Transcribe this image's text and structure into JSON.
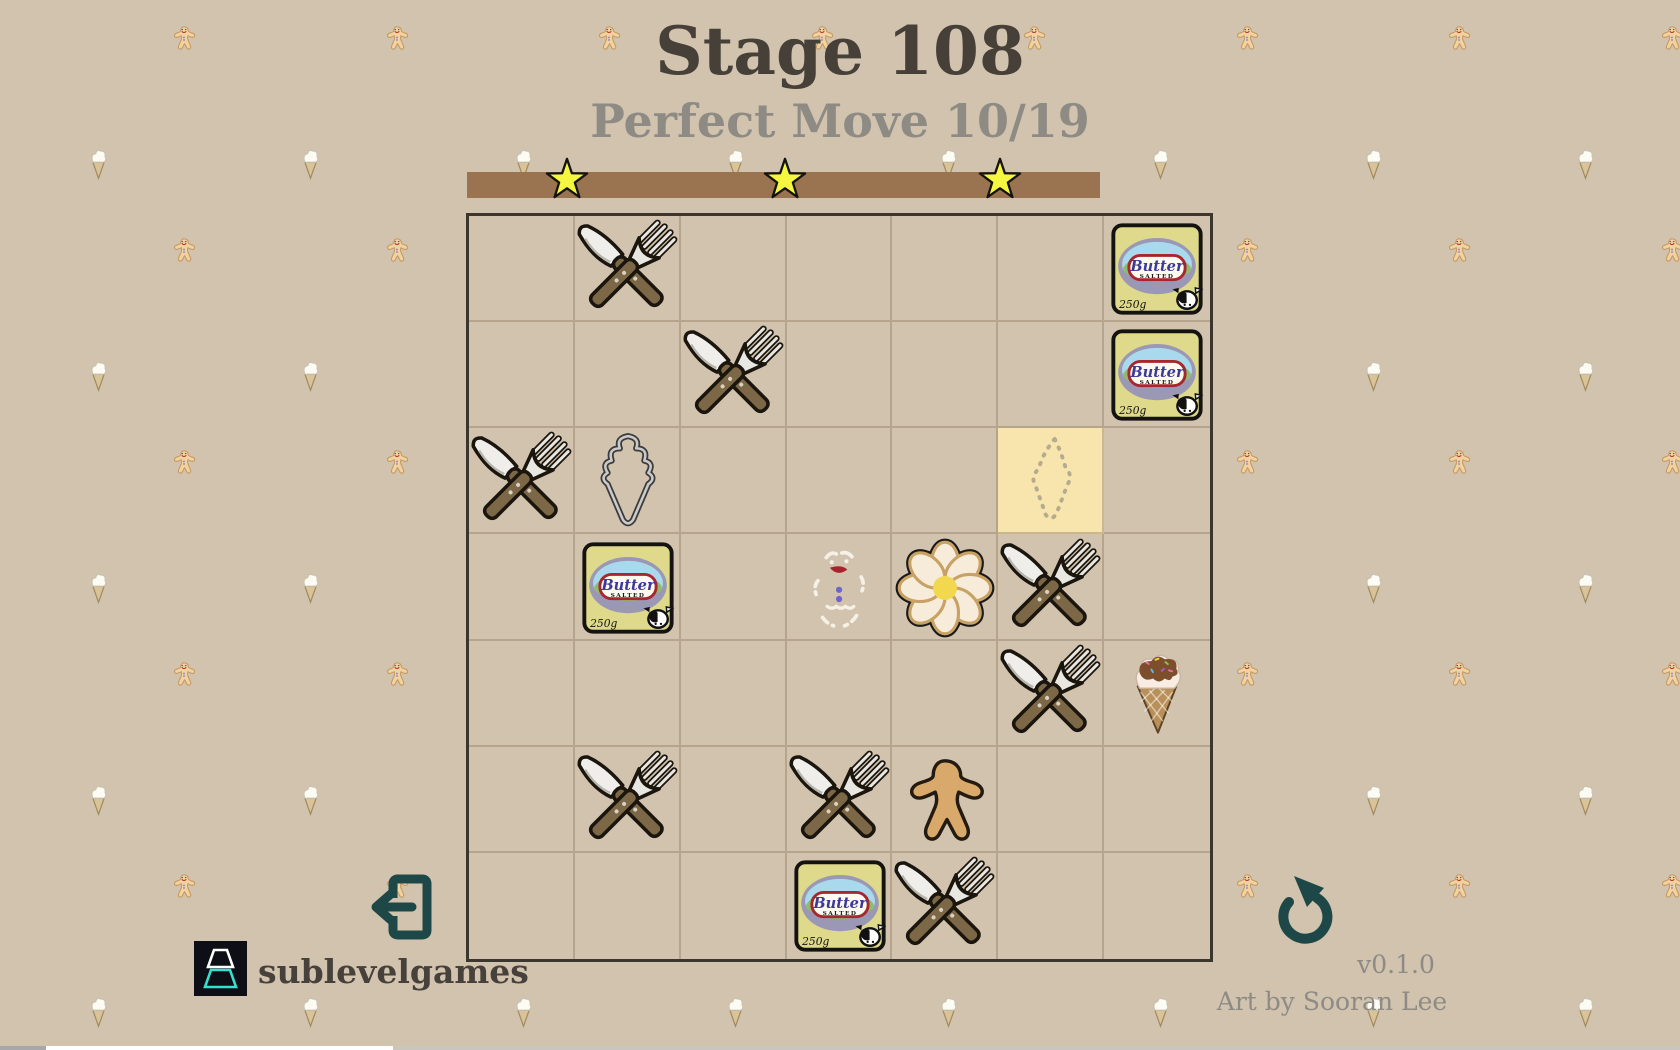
{
  "header": {
    "title": "Stage 108",
    "subtitle": "Perfect Move 10/19"
  },
  "progress": {
    "stars": 3,
    "star_icon": "star-icon",
    "bar_name": "stage-progress-bar"
  },
  "board": {
    "rows": 7,
    "cols": 7,
    "highlight": {
      "row": 3,
      "col": 6,
      "meaning": "possible-move-cell",
      "ghost": "dashed-cookie-outline"
    },
    "items": [
      {
        "row": 1,
        "col": 2,
        "type": "utensils"
      },
      {
        "row": 1,
        "col": 7,
        "type": "butter"
      },
      {
        "row": 2,
        "col": 3,
        "type": "utensils"
      },
      {
        "row": 2,
        "col": 7,
        "type": "butter"
      },
      {
        "row": 3,
        "col": 1,
        "type": "utensils"
      },
      {
        "row": 3,
        "col": 2,
        "type": "cutter-outline"
      },
      {
        "row": 4,
        "col": 2,
        "type": "butter"
      },
      {
        "row": 4,
        "col": 4,
        "type": "icing-ghost"
      },
      {
        "row": 4,
        "col": 5,
        "type": "flower-cookie"
      },
      {
        "row": 4,
        "col": 6,
        "type": "utensils"
      },
      {
        "row": 5,
        "col": 6,
        "type": "utensils"
      },
      {
        "row": 5,
        "col": 7,
        "type": "ice-cream"
      },
      {
        "row": 6,
        "col": 2,
        "type": "utensils"
      },
      {
        "row": 6,
        "col": 4,
        "type": "utensils"
      },
      {
        "row": 6,
        "col": 5,
        "type": "gingerbread-man"
      },
      {
        "row": 7,
        "col": 4,
        "type": "butter"
      },
      {
        "row": 7,
        "col": 5,
        "type": "utensils"
      }
    ]
  },
  "butter_label": {
    "name": "Butter",
    "variant": "SALTED",
    "weight": "250g"
  },
  "buttons": {
    "exit": "exit-icon",
    "restart": "restart-icon"
  },
  "background_pattern": {
    "icons": [
      "gingerbread-pattern-icon",
      "ice-cream-pattern-icon"
    ]
  },
  "footer": {
    "brand": "sublevelgames",
    "version": "v0.1.0",
    "credit": "Art by Sooran Lee"
  },
  "colors": {
    "background": "#d2c3ae",
    "progress_bar": "#9a7450",
    "star": "#f5f63f",
    "title_text": "#474038",
    "muted_text": "#8e8b85",
    "accent_teal": "#1e4848",
    "highlight_cell": "#f8e5ad",
    "board_border": "#3b372f"
  }
}
